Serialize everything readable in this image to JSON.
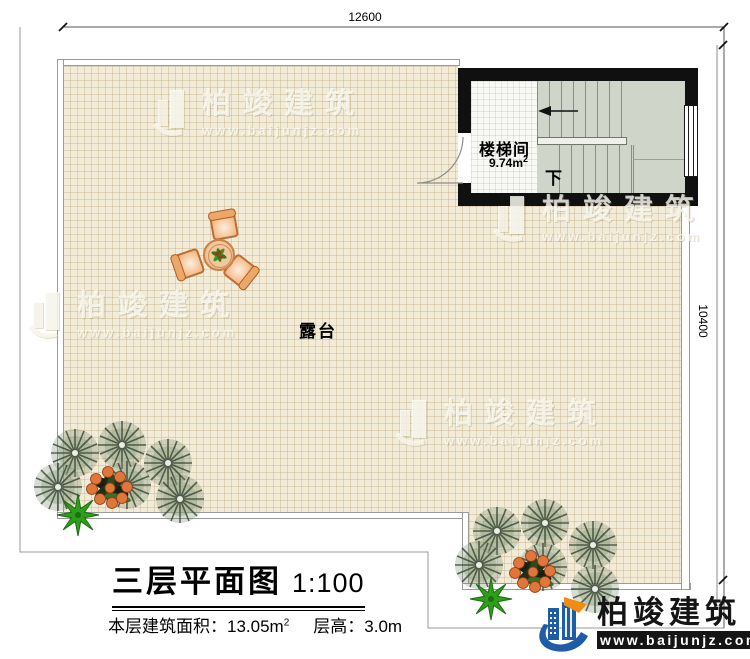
{
  "dimensions": {
    "top": "12600",
    "right": "10400"
  },
  "rooms": {
    "terrace_label": "露台",
    "stair_label": "楼梯间",
    "stair_area": "9.74m",
    "stair_area_sup": "2",
    "stair_down": "下"
  },
  "title": {
    "main": "三层平面图",
    "scale": "1:100"
  },
  "stats": {
    "area_label": "本层建筑面积：",
    "area_value": "13.05m",
    "area_sup": "2",
    "height_label": "层高：",
    "height_value": "3.0m"
  },
  "brand": {
    "name": "柏竣建筑",
    "url": "www.baijunjz.com"
  },
  "watermark": {
    "name": "柏竣建筑",
    "url": "www.baijunjz.com"
  },
  "colors": {
    "brand_blue": "#1e5ca6",
    "brand_orange": "#ef8d13",
    "wall_black": "#101010",
    "terrace_fill": "#f2ebd7",
    "stair_floor": "#cfd5c8"
  }
}
